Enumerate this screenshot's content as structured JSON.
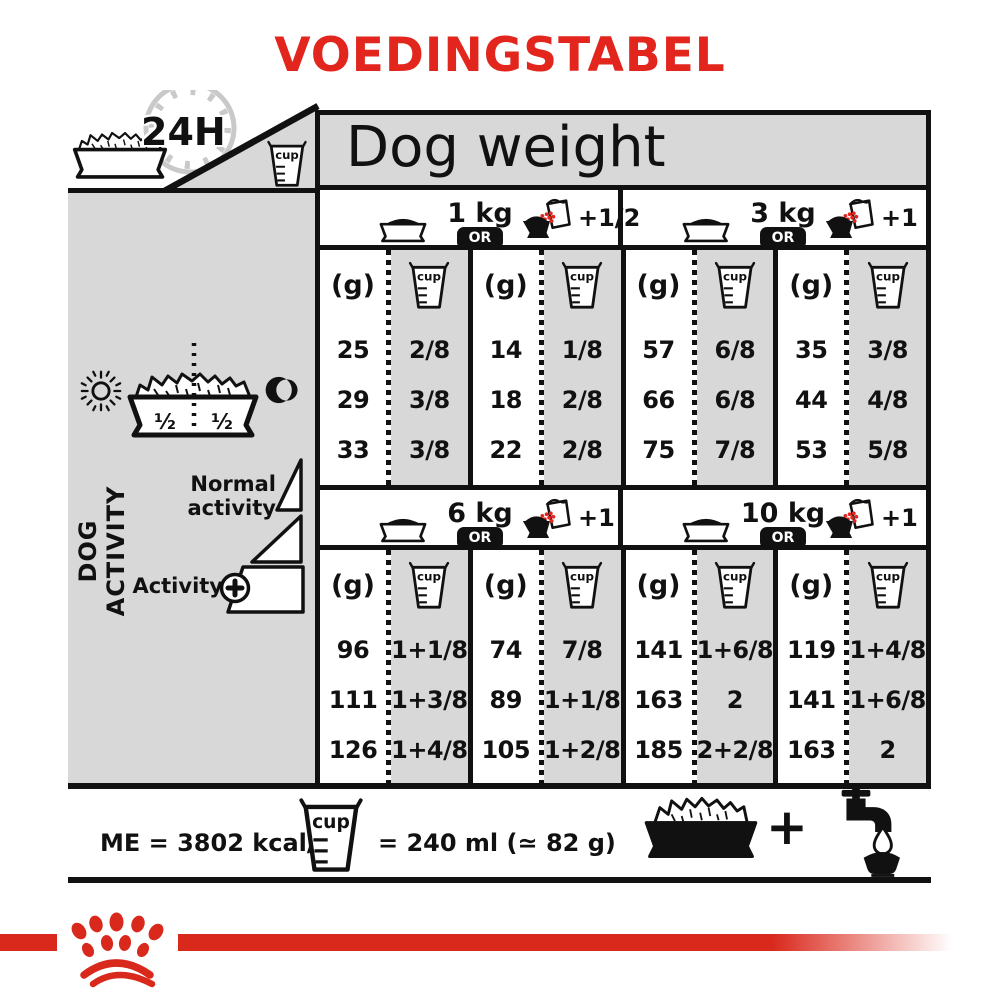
{
  "title": "VOEDINGSTABEL",
  "colors": {
    "accent_red": "#e2261d",
    "logo_red": "#d9291c",
    "panel_gray": "#d8d8d8",
    "line_black": "#111111",
    "clock_gray": "#c9c9c9"
  },
  "top": {
    "duration_label": "24H",
    "table_title": "Dog weight"
  },
  "sidebar": {
    "axis_label": "DOG ACTIVITY",
    "half_label": "½",
    "normal_activity_label": "Normal activity",
    "activity_label": "Activity"
  },
  "table": {
    "or_label": "OR",
    "g_header": "(g)",
    "cup_label": "cup",
    "sections": [
      {
        "weight": "1 kg",
        "extra": "+1/2",
        "options": [
          {
            "g": [
              "25",
              "29",
              "33"
            ],
            "cup": [
              "2/8",
              "3/8",
              "3/8"
            ]
          },
          {
            "g": [
              "14",
              "18",
              "22"
            ],
            "cup": [
              "1/8",
              "2/8",
              "2/8"
            ]
          }
        ]
      },
      {
        "weight": "3 kg",
        "extra": "+1",
        "options": [
          {
            "g": [
              "57",
              "66",
              "75"
            ],
            "cup": [
              "6/8",
              "6/8",
              "7/8"
            ]
          },
          {
            "g": [
              "35",
              "44",
              "53"
            ],
            "cup": [
              "3/8",
              "4/8",
              "5/8"
            ]
          }
        ]
      },
      {
        "weight": "6 kg",
        "extra": "+1",
        "options": [
          {
            "g": [
              "96",
              "111",
              "126"
            ],
            "cup": [
              "1+1/8",
              "1+3/8",
              "1+4/8"
            ]
          },
          {
            "g": [
              "74",
              "89",
              "105"
            ],
            "cup": [
              "7/8",
              "1+1/8",
              "1+2/8"
            ]
          }
        ]
      },
      {
        "weight": "10 kg",
        "extra": "+1",
        "options": [
          {
            "g": [
              "141",
              "163",
              "185"
            ],
            "cup": [
              "1+6/8",
              "2",
              "2+2/8"
            ]
          },
          {
            "g": [
              "119",
              "141",
              "163"
            ],
            "cup": [
              "1+4/8",
              "1+6/8",
              "2"
            ]
          }
        ]
      }
    ]
  },
  "footer": {
    "me_label": "ME = 3802 kcal/kg",
    "cup_equiv_label": "= 240 ml (≃ 82 g)",
    "plus": "+"
  }
}
